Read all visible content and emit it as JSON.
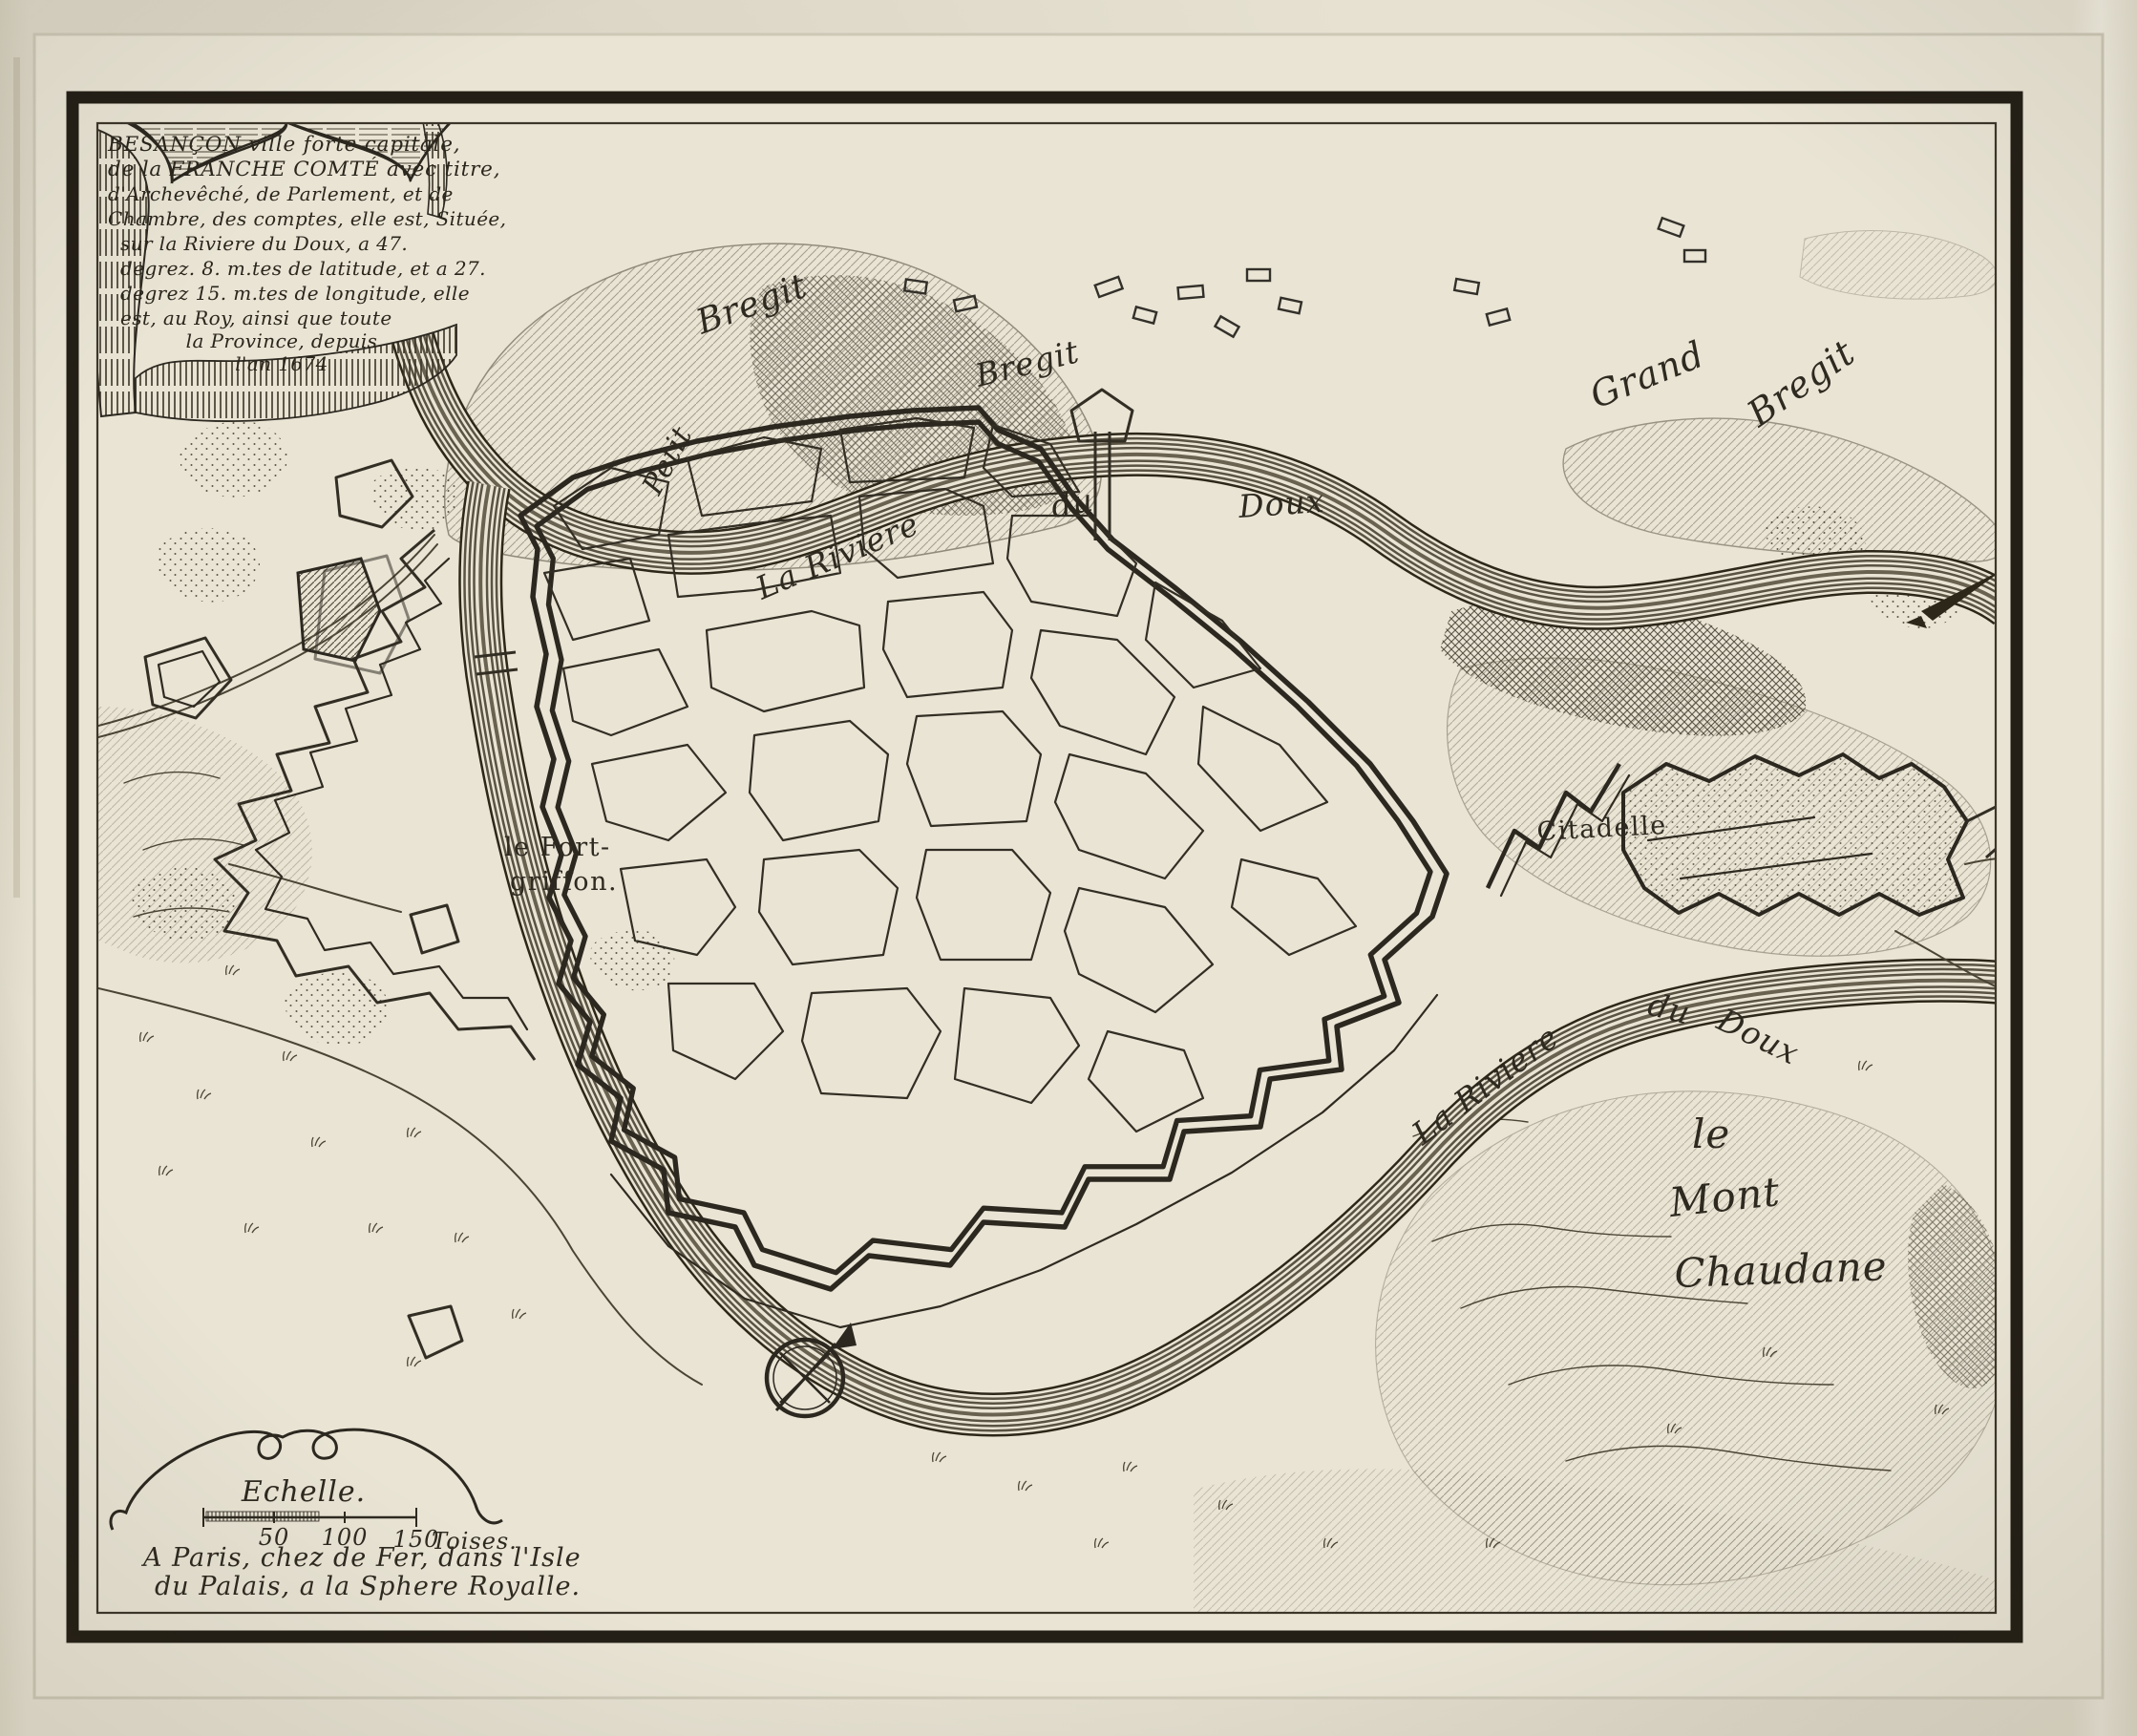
{
  "colors": {
    "paper": "#e9e4d4",
    "ink": "#2f2a20",
    "frame": "#241f16"
  },
  "cartouche": {
    "lines": [
      "BESANÇON ville forte capitale,",
      "de la FRANCHE COMTÉ avec titre,",
      "d'Archevêché, de Parlement, et de",
      "Chambre, des comptes, elle est, Située,",
      "sur la Riviere du Doux, a 47.",
      "degrez. 8. m.tes de latitude, et a 27.",
      "degrez 15. m.tes de longitude, elle",
      "est, au Roy, ainsi que toute",
      "la Province, depuis",
      "l'an 1674"
    ]
  },
  "labels": {
    "petit": "Petit",
    "bregit_west": "Bregit",
    "bregit_center": "Bregit",
    "grand": "Grand",
    "bregit_east": "Bregit",
    "river_top_la": "La Riviere",
    "river_top_du": "du",
    "river_top_doux": "Doux",
    "fort_line1": "le Fort-",
    "fort_line2": "griffon.",
    "citadelle": "Citadelle",
    "river_south_la": "La Riviere",
    "river_south_du": "du",
    "river_south_doux": "Doux",
    "mont_le": "le",
    "mont_word": "Mont",
    "chaudane": "Chaudane"
  },
  "scale": {
    "title": "Echelle.",
    "tick_50": "50",
    "tick_100": "100",
    "tick_150": "150",
    "unit": "Toises.",
    "imprint_line1": "A Paris, chez de Fer, dans l'Isle",
    "imprint_line2": "du Palais, a la Sphere Royalle."
  }
}
